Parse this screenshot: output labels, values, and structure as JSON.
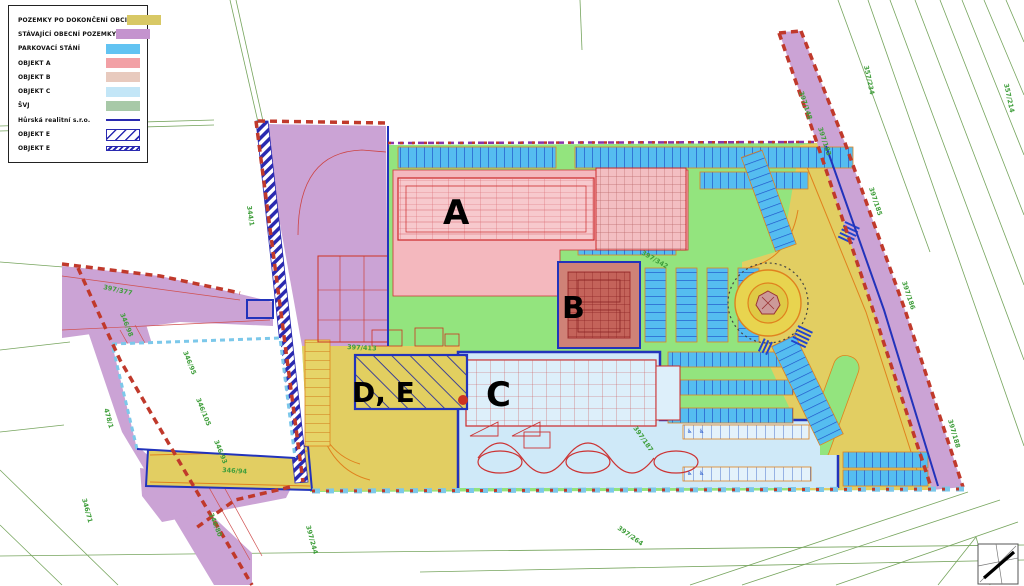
{
  "legend": {
    "items": [
      {
        "label": "POZEMKY PO DOKONČENÍ OBCI",
        "swatch": "solid",
        "color": "#d8c865"
      },
      {
        "label": "STÁVAJÍCÍ OBECNÍ POZEMKY",
        "swatch": "solid",
        "color": "#c493ce"
      },
      {
        "label": "PARKOVACÍ STÁNÍ",
        "swatch": "solid",
        "color": "#62c3f2"
      },
      {
        "label": "OBJEKT A",
        "swatch": "solid",
        "color": "#f2a0a5"
      },
      {
        "label": "OBJEKT B",
        "swatch": "solid",
        "color": "#e8cabe"
      },
      {
        "label": "OBJEKT C",
        "swatch": "solid",
        "color": "#c3e6f7"
      },
      {
        "label": "ŠVJ",
        "swatch": "solid",
        "color": "#a8c9a8"
      },
      {
        "label": "Hůrská realitní s.r.o.",
        "swatch": "line",
        "color": "#2a2ab0"
      },
      {
        "label": "OBJEKT E",
        "swatch": "hatch",
        "color": "#2a2ab0"
      },
      {
        "label": "OBJEKT E",
        "swatch": "dense",
        "color": "#2a2ab0"
      }
    ]
  },
  "plan": {
    "building_labels": [
      {
        "text": "A",
        "x": 443,
        "y": 224,
        "size": 34
      },
      {
        "text": "B",
        "x": 562,
        "y": 318,
        "size": 30
      },
      {
        "text": "C",
        "x": 486,
        "y": 406,
        "size": 34
      },
      {
        "text": "D, E",
        "x": 352,
        "y": 402,
        "size": 28
      }
    ],
    "parcel_labels": [
      {
        "text": "357/234",
        "x": 864,
        "y": 66,
        "rot": 78
      },
      {
        "text": "357/214",
        "x": 1004,
        "y": 84,
        "rot": 78
      },
      {
        "text": "397/148",
        "x": 799,
        "y": 92,
        "rot": 72
      },
      {
        "text": "397/183",
        "x": 818,
        "y": 128,
        "rot": 72
      },
      {
        "text": "397/185",
        "x": 869,
        "y": 188,
        "rot": 72
      },
      {
        "text": "397/186",
        "x": 902,
        "y": 282,
        "rot": 72
      },
      {
        "text": "397/188",
        "x": 948,
        "y": 420,
        "rot": 74
      },
      {
        "text": "344/1",
        "x": 247,
        "y": 206,
        "rot": 82
      },
      {
        "text": "397/377",
        "x": 103,
        "y": 289,
        "rot": 12
      },
      {
        "text": "346/98",
        "x": 120,
        "y": 314,
        "rot": 68
      },
      {
        "text": "346/95",
        "x": 183,
        "y": 352,
        "rot": 68
      },
      {
        "text": "346/105",
        "x": 196,
        "y": 399,
        "rot": 68
      },
      {
        "text": "346/93",
        "x": 214,
        "y": 441,
        "rot": 68
      },
      {
        "text": "346/94",
        "x": 222,
        "y": 472,
        "rot": 4
      },
      {
        "text": "346/80",
        "x": 209,
        "y": 514,
        "rot": 68
      },
      {
        "text": "478/1",
        "x": 104,
        "y": 409,
        "rot": 75
      },
      {
        "text": "346/71",
        "x": 82,
        "y": 499,
        "rot": 75
      },
      {
        "text": "397/264",
        "x": 617,
        "y": 529,
        "rot": 35
      },
      {
        "text": "397/244",
        "x": 306,
        "y": 526,
        "rot": 75
      },
      {
        "text": "397/342",
        "x": 641,
        "y": 254,
        "rot": 30
      },
      {
        "text": "397/413",
        "x": 347,
        "y": 349,
        "rot": 3
      },
      {
        "text": "397/187",
        "x": 633,
        "y": 428,
        "rot": 55
      }
    ],
    "accessible_parking_icon": "♿",
    "colors": {
      "site_green": "#93e47e",
      "road_yellow": "#e2ce62",
      "municipal_purple": "#cba3d5",
      "parking_blue": "#55bdf0",
      "objekt_a_pink": "#f4b8be",
      "objekt_b_red": "#c4635a",
      "objekt_c_blue": "#cfe9f8",
      "boundary_red_dashed": "#c0392b",
      "boundary_blue": "#2233bb",
      "boundary_cyan_dashed": "#7cc8ea",
      "cadastre_line_green": "#6fa055",
      "road_edge_orange": "#e0821e"
    }
  }
}
